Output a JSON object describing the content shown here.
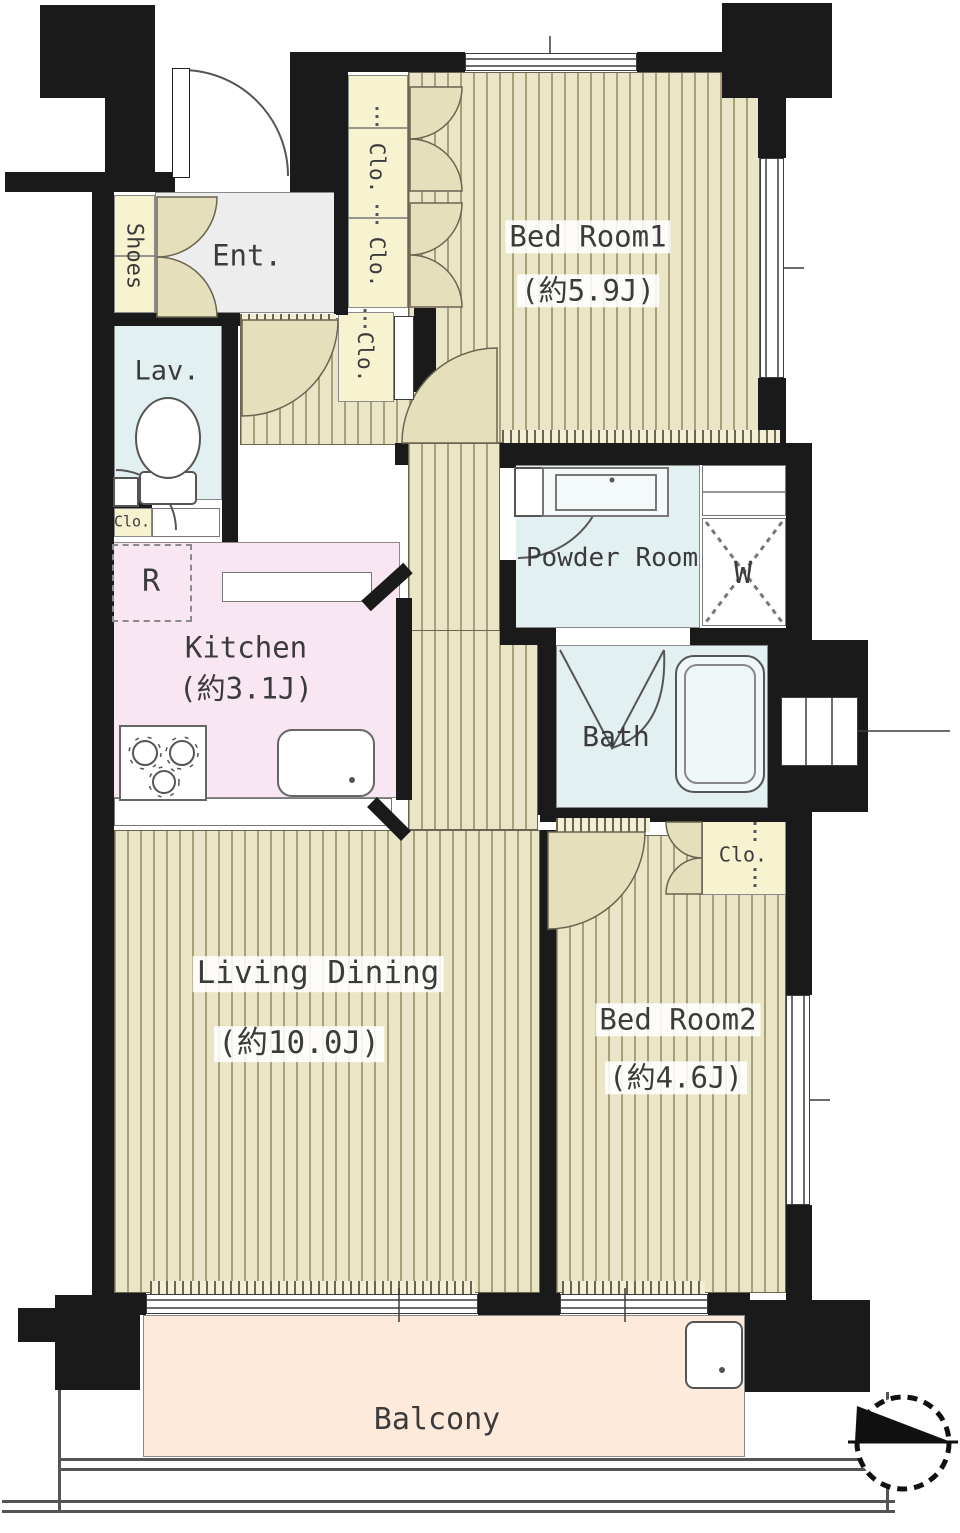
{
  "rooms": {
    "bed_room1": {
      "name": "Bed Room1",
      "area": "(約5.9J)"
    },
    "bed_room2": {
      "name": "Bed Room2",
      "area": "(約4.6J)"
    },
    "living_dining": {
      "name": "Living Dining",
      "area": "(約10.0J)"
    },
    "kitchen": {
      "name": "Kitchen",
      "area": "(約3.1J)"
    },
    "powder_room": {
      "name": "Powder Room"
    },
    "bath": {
      "name": "Bath"
    },
    "lavatory": {
      "name": "Lav."
    },
    "entrance": {
      "name": "Ent."
    },
    "balcony": {
      "name": "Balcony"
    }
  },
  "labels": {
    "closet": "Clo.",
    "shoes": "Shoes",
    "washer": "W",
    "refrigerator": "R"
  },
  "colors": {
    "wall": "#1a1a1a",
    "flooring": "#ebe5c7",
    "flooring_stripe": "#a99f79",
    "closet": "#f7f3d0",
    "wet_area": "#e3f0f2",
    "kitchen": "#f9e6f3",
    "entrance": "#ededed",
    "balcony": "#fdeadb",
    "door_swing": "#e6dfbc"
  }
}
